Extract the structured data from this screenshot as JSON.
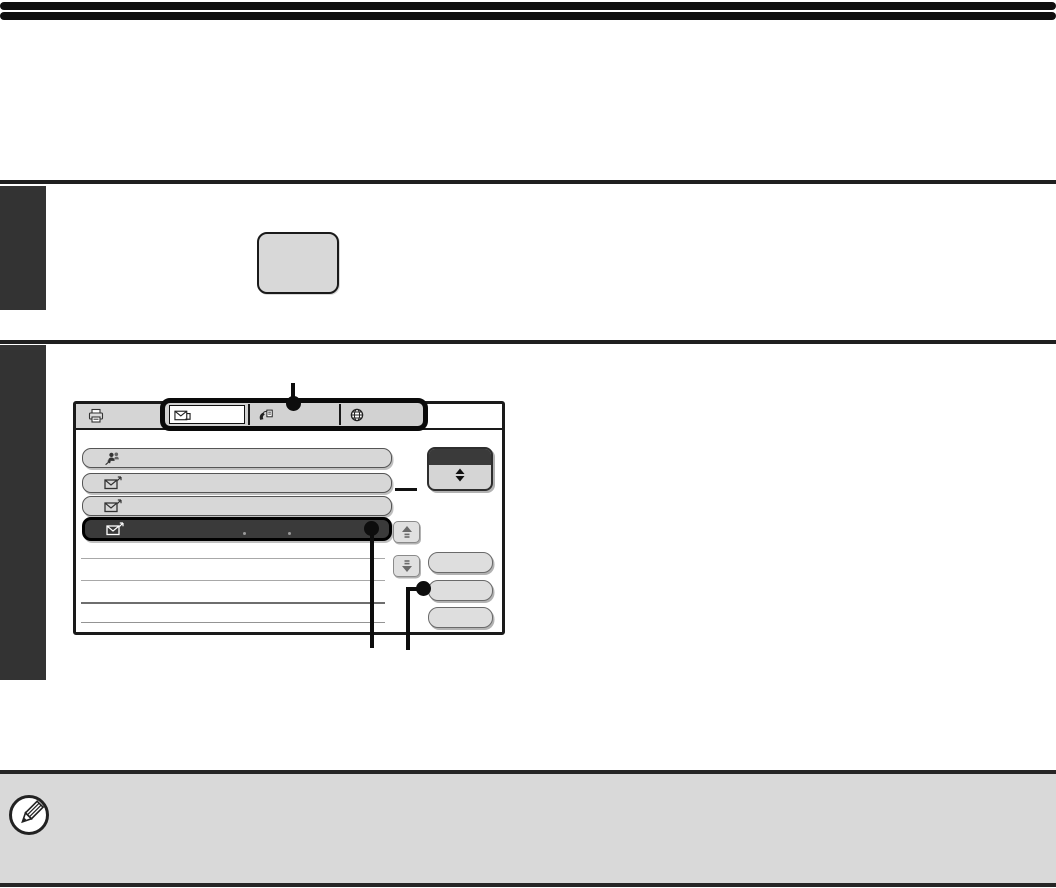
{
  "document": {
    "kind": "printer-manual-page",
    "visible_text": "",
    "header": {
      "rule_count": 2
    },
    "note": {
      "icon": "pencil-note-icon",
      "text": ""
    }
  },
  "colors": {
    "rule_black": "#0f0f0f",
    "step_block": "#333333",
    "key_button_fill": "#d8d8d8",
    "screen_border": "#1a1a1a",
    "button_gray": "#d7d7d7",
    "selected_item_bg": "#3a3a3a",
    "sort_box_header": "#3a3a3a",
    "note_background": "#d9d9d9",
    "callout_black": "#0d0d0d"
  },
  "steps": [
    {
      "index": 1,
      "content": "hardware-key-illustration",
      "text": ""
    },
    {
      "index": 2,
      "content": "touch-screen-illustration",
      "text": ""
    }
  ],
  "screen": {
    "toolbar": {
      "left_icon": "printer-icon",
      "tabs": [
        {
          "icon": "email-tab-icon",
          "selected": true,
          "label": ""
        },
        {
          "icon": "fax-tab-icon",
          "selected": false,
          "label": ""
        },
        {
          "icon": "internet-fax-tab-icon",
          "selected": false,
          "label": ""
        }
      ],
      "highlighted_by_callout": true
    },
    "address_list": {
      "items": [
        {
          "icon": "group-address-icon",
          "selected": false,
          "label": ""
        },
        {
          "icon": "email-address-icon",
          "selected": false,
          "label": ""
        },
        {
          "icon": "email-address-icon",
          "selected": false,
          "label": ""
        },
        {
          "icon": "email-address-icon",
          "selected": true,
          "label": "",
          "highlighted_by_callout": true
        }
      ],
      "empty_separator_rows": 4
    },
    "right_controls": {
      "sort_scroll_box": {
        "icon": "double-diamond-icon",
        "label": ""
      },
      "scroll_up_button": {
        "icon": "arrow-up-icon"
      },
      "scroll_down_button": {
        "icon": "arrow-down-icon"
      },
      "side_buttons": [
        {
          "label": ""
        },
        {
          "label": "",
          "highlighted_by_callout": true
        },
        {
          "label": ""
        }
      ]
    }
  },
  "callouts": {
    "tab_row_pointer": true,
    "selected_item_pointer": true,
    "side_button_pointer": true
  }
}
